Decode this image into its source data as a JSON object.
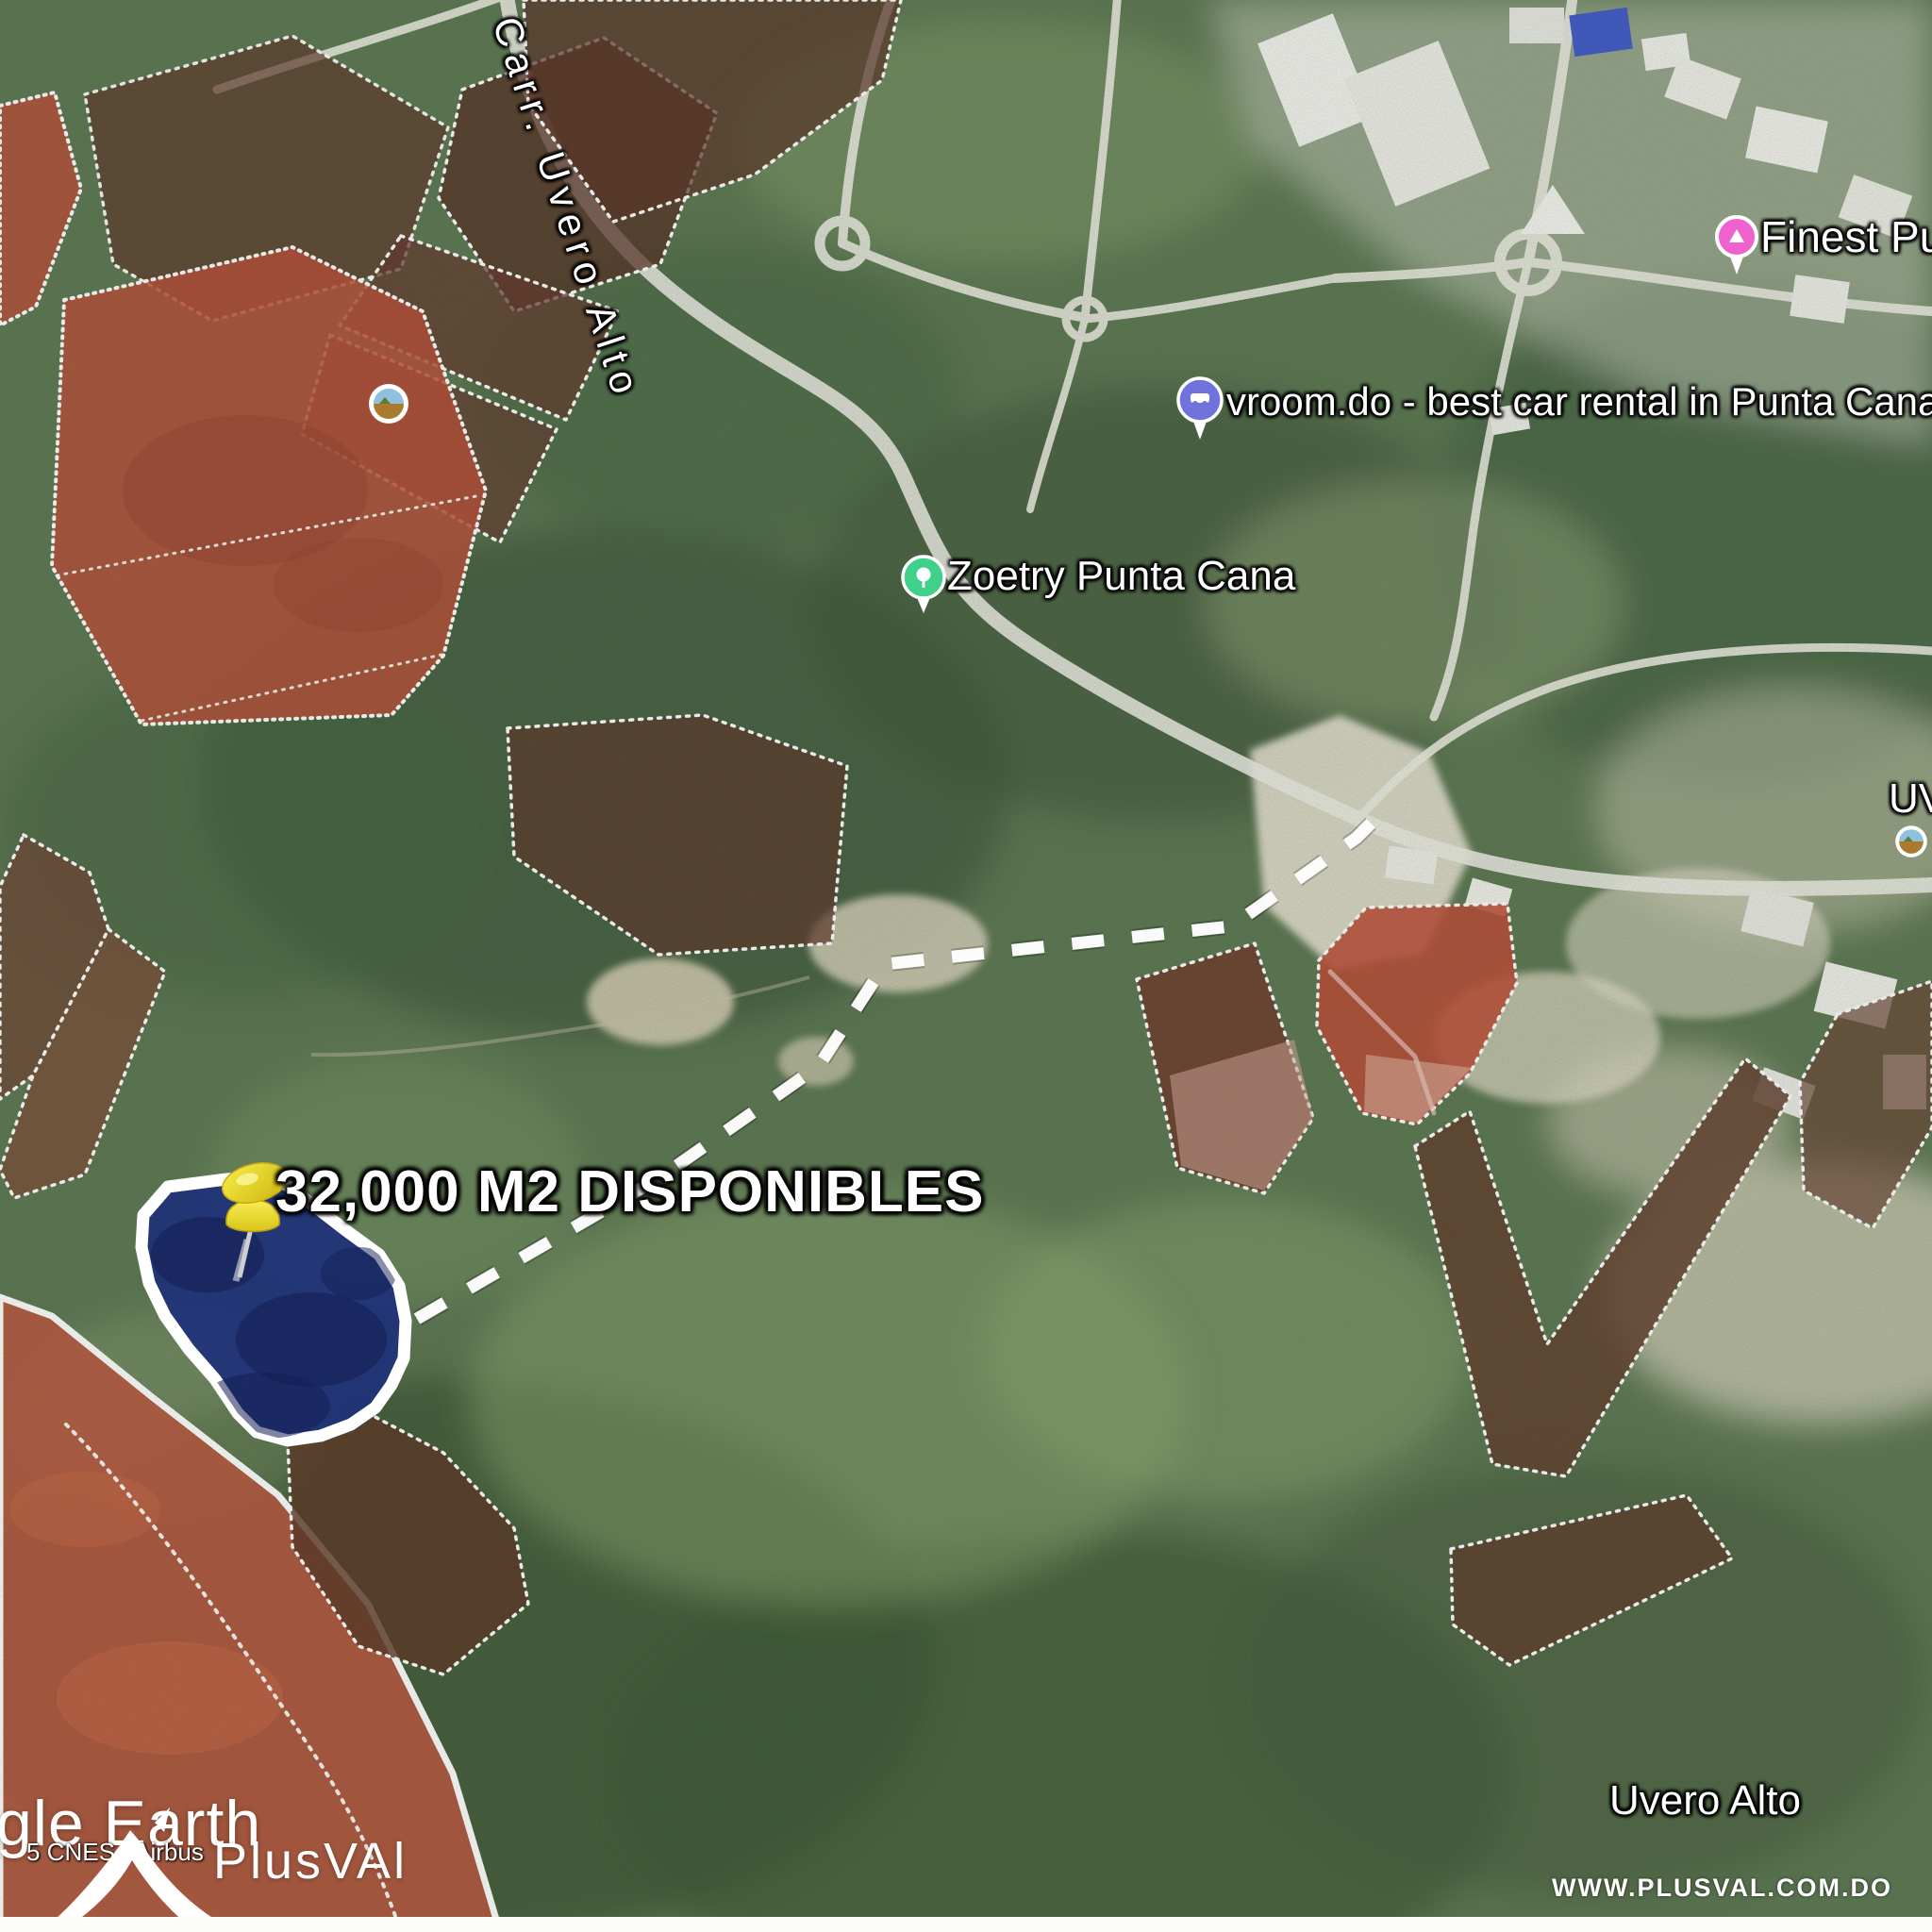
{
  "map_labels": {
    "road": "Carr. Uvero Alto",
    "zoetry": "Zoetry Punta Cana",
    "vroom": "vroom.do - best car rental in Punta Cana",
    "finest": "Finest Pun",
    "uv_partial": "UV",
    "town": "Uvero Alto"
  },
  "annotation": {
    "area_label": "32,000 M2 DISPONIBLES"
  },
  "branding": {
    "google_earth_partial": "gle Earth",
    "imagery_copyright_partial": "5 CNES / Airbus",
    "watermark_wordmark": "PlusVAl",
    "website": "WWW.PLUSVAL.COM.DO"
  },
  "legend_colors": {
    "available_parcel_fill": "#1e3178",
    "parcel_red": "#b94c36",
    "parcel_maroon": "#5e3226",
    "parcel_border": "#ffffff",
    "route_dash": "#ffffff",
    "pushpin_yellow": "#f0df28",
    "pin_zoetry": "#3fd08a",
    "pin_vroom": "#7173dc",
    "pin_finest": "#f062ce"
  }
}
